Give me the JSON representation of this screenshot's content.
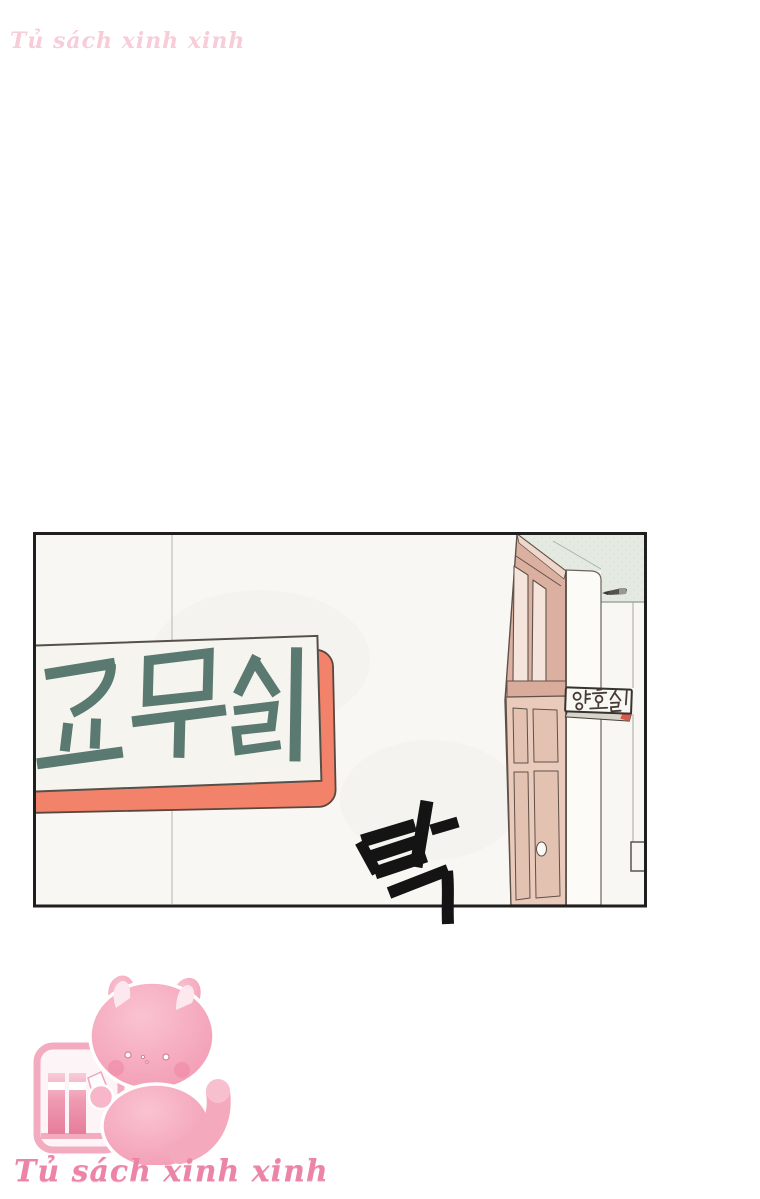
{
  "watermarks": {
    "top": "Tủ sách xinh xinh",
    "bottom": "Tủ sách xinh xinh"
  },
  "panel": {
    "description": "school hallway with teachers office sign and nurse office door",
    "teachers_office_sign_text": "교무실",
    "nurse_office_sign_text": "양호실",
    "sfx_text": "탁"
  },
  "logo": {
    "mascot": "pink-cat-bookshelf-mascot"
  },
  "colors": {
    "sign_board": "#f2836a",
    "sign_face": "#f6f4ef",
    "sign_text": "#5a7970",
    "door_face": "#e9cabb",
    "door_trim": "#dcb0a0",
    "ceiling": "#e4eae2",
    "wall": "#f8f7f3",
    "panel_border": "#1f1f1f",
    "sfx_ink": "#141414",
    "plaque_text": "#463c35",
    "plaque_accent": "#dd5a4a",
    "brand_pink": "#ec84a8",
    "mascot_pink": "#f5a9bd"
  }
}
